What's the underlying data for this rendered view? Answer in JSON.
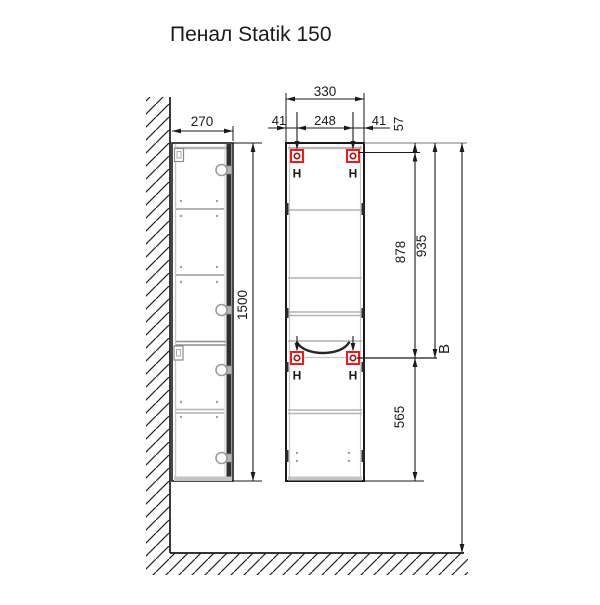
{
  "title": "Пенал Statik 150",
  "side_view": {
    "width_mm": "270",
    "height_mm": "1500"
  },
  "front_view": {
    "width_mm": "330",
    "left_hanger_offset_mm": "41",
    "hanger_spacing_mm": "248",
    "right_hanger_offset_mm": "41",
    "hanger_top_drop_mm": "57",
    "hanger_vertical_span_mm": "878",
    "top_to_lower_hanger_mm": "935",
    "lower_hanger_to_bottom_mm": "565",
    "mounting_height_label": "B",
    "hanger_label": "H"
  },
  "colors": {
    "line": "#1a1a1a",
    "marker_red": "#ed1c1c",
    "marker_ring": "#9b1010",
    "shelf_gray": "#b4b4b4"
  }
}
